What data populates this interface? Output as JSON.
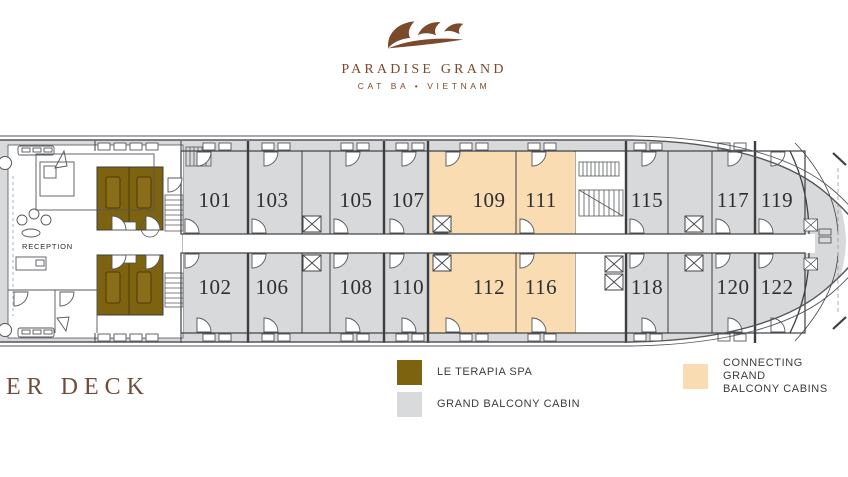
{
  "brand": {
    "name": "PARADISE GRAND",
    "location": "CAT BA • VIETNAM"
  },
  "deck": {
    "title_visible": "ER DECK",
    "reception_label": "RECEPTION",
    "cabins_top": [
      {
        "number": "101",
        "type": "grand"
      },
      {
        "number": "103",
        "type": "grand"
      },
      {
        "number": "105",
        "type": "grand"
      },
      {
        "number": "107",
        "type": "grand"
      },
      {
        "number": "109",
        "type": "connecting"
      },
      {
        "number": "111",
        "type": "connecting"
      },
      {
        "number": "115",
        "type": "grand"
      },
      {
        "number": "117",
        "type": "grand"
      },
      {
        "number": "119",
        "type": "grand"
      }
    ],
    "cabins_bottom": [
      {
        "number": "102",
        "type": "grand"
      },
      {
        "number": "106",
        "type": "grand"
      },
      {
        "number": "108",
        "type": "grand"
      },
      {
        "number": "110",
        "type": "grand"
      },
      {
        "number": "112",
        "type": "connecting"
      },
      {
        "number": "116",
        "type": "connecting"
      },
      {
        "number": "118",
        "type": "grand"
      },
      {
        "number": "120",
        "type": "grand"
      },
      {
        "number": "122",
        "type": "grand"
      }
    ]
  },
  "legend": {
    "spa": {
      "label": "LE TERAPIA SPA"
    },
    "grand": {
      "label": "GRAND BALCONY CABIN"
    },
    "connecting": {
      "line1": "CONNECTING GRAND",
      "line2": "BALCONY CABINS"
    }
  },
  "colors": {
    "spa": "#7d6310",
    "cabin": "#d7d9da",
    "connecting": "#f9dcb2",
    "hull_outline": "#54565a",
    "brand_brown": "#7b4a2c",
    "title_brown": "#6f4c3c",
    "number_ink": "#2f2f2f"
  }
}
